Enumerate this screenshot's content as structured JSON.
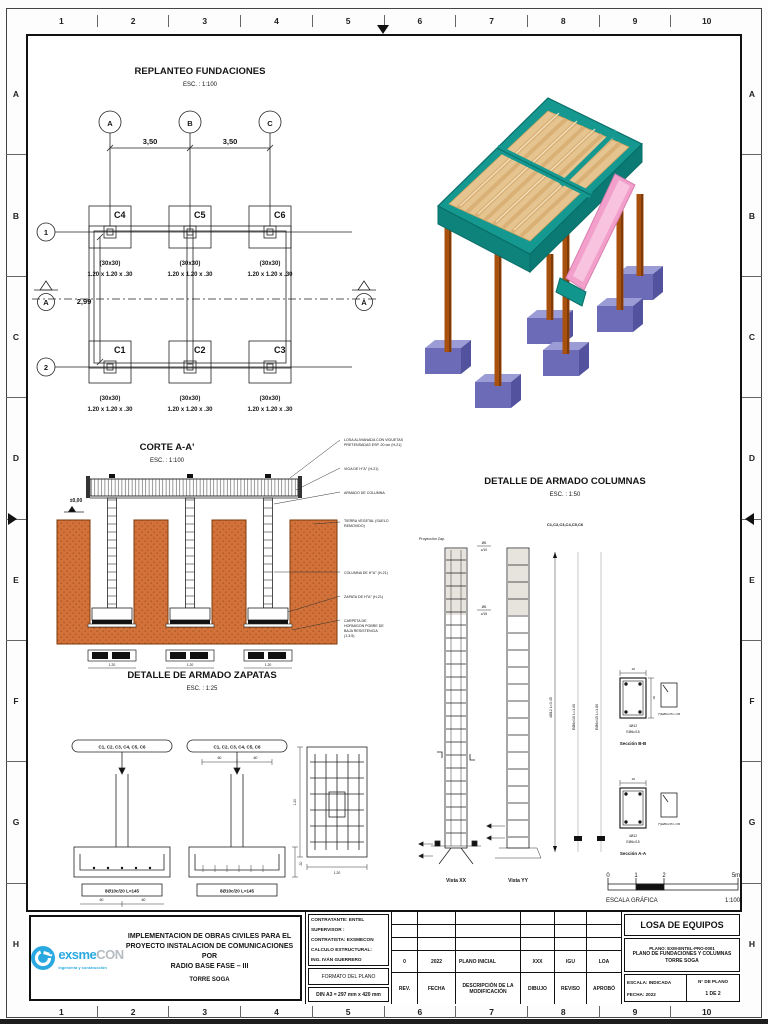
{
  "sheet": {
    "cols": [
      "1",
      "2",
      "3",
      "4",
      "5",
      "6",
      "7",
      "8",
      "9",
      "10"
    ],
    "rows": [
      "A",
      "B",
      "C",
      "D",
      "E",
      "F",
      "G",
      "H"
    ]
  },
  "replanteo": {
    "title": "REPLANTEO FUNDACIONES",
    "scale": "ESC. : 1:100",
    "axis_a": "A",
    "axis_b": "B",
    "axis_c": "C",
    "row_1": "1",
    "row_2": "2",
    "dim_ab": "3,50",
    "dim_bc": "3,50",
    "dim_12": "2,99",
    "section_left": "A",
    "section_right": "A",
    "columns": [
      {
        "name": "C4",
        "size": "(30x30)",
        "footing": "1.20 x 1.20 x .30"
      },
      {
        "name": "C5",
        "size": "(30x30)",
        "footing": "1.20 x 1.20 x .30"
      },
      {
        "name": "C6",
        "size": "(30x30)",
        "footing": "1.20 x 1.20 x .30"
      },
      {
        "name": "C1",
        "size": "(30x30)",
        "footing": "1.20 x 1.20 x .30"
      },
      {
        "name": "C2",
        "size": "(30x30)",
        "footing": "1.20 x 1.20 x .30"
      },
      {
        "name": "C3",
        "size": "(30x30)",
        "footing": "1.20 x 1.20 x .30"
      }
    ]
  },
  "corte": {
    "title": "CORTE A-A'",
    "scale": "ESC. : 1:100",
    "level": "±0,00",
    "callout_1a": "LOSA ALIVIANADA CON VIGUETAS",
    "callout_1b": "PRETENSADAS ESP. 20 cm (H-21)",
    "callout_2": "VIGA DE H°A° (H-21)",
    "callout_3": "ARMADO DE COLUMNA",
    "callout_4a": "TIERRA VEGETAL (SUELO",
    "callout_4b": "REMOVIDO)",
    "callout_5": "COLUMNA DE H°A° (H-21)",
    "callout_6": "ZAPATA DE H°A° (H-21)",
    "callout_7a": "CARPETA DE",
    "callout_7b": "HORMIGON POBRE DE",
    "callout_7c": "BAJA RESISTENCIA",
    "callout_7d": "(1:3:5)",
    "dim_footing": "1.20"
  },
  "zapatas": {
    "title": "DETALLE DE ARMADO ZAPATAS",
    "scale": "ESC. : 1:25",
    "tag_1": "C1, C2, C3, C4, C5, C6",
    "tag_2": "C1, C2, C3, C4, C5, C6",
    "bar_label_1": "8Ø10c/20 L=145",
    "bar_label_2": "8Ø10c/20 L=145",
    "dim_a": ".60",
    "dim_b": ".60",
    "dim_top_a": ".60",
    "dim_top_b": ".60",
    "dim_side": ".30",
    "plan_dim_w": "1.20",
    "plan_dim_h": "1.20"
  },
  "columnas": {
    "title": "DETALLE DE ARMADO COLUMNAS",
    "scale": "ESC. : 1:50",
    "tag": "C1,C2,C3,C4,C5,C6",
    "proyeccion": "Proyección Zap.",
    "frac1_a": "Ø6",
    "frac1_b": "c/10",
    "frac2_a": "Ø6",
    "frac2_b": "c/15",
    "vista_1": "Vista XX",
    "vista_2": "Vista YY",
    "dim_total": "4Ø12 L=3.45",
    "rot_label_1": "EØ6c/10 L=1.00",
    "rot_label_2": "EØ6c/15 L=1.80",
    "dim_w": ".20",
    "dim_h": ".30",
    "sec_b_bars": "4Ø12",
    "sec_b_stirrup": "EØ6c/15",
    "sec_b_title": "Sección B-B",
    "sec_a_bars": "4Ø12",
    "sec_a_stirrup": "EØ6c/15",
    "sec_a_title": "Sección A-A",
    "stirrup_note_1": "(*)EØ6c/15 L=45",
    "stirrup_note_2": "(*)EØ6c/15 L=45"
  },
  "graphic_scale": {
    "t0": "0",
    "t1": "1",
    "t2": "2",
    "t5": "5m",
    "label": "ESCALA GRÁFICA",
    "ratio": "1:100"
  },
  "titleblock": {
    "logo_main": "exsme",
    "logo_suffix": "CON",
    "logo_tagline": "ingeniería y construcción",
    "project_line1": "IMPLEMENTACION DE OBRAS CIVILES PARA EL",
    "project_line2": "PROYECTO INSTALACION DE COMUNICACIONES POR",
    "project_line3": "RADIO BASE FASE – III",
    "project_line4": "TORRE SOGA",
    "info_line1": "CONTRATANTE: ENTEL",
    "info_line2": "SUPERVISOR :",
    "info_line3": "CONTRATISTA: EXSMECON",
    "info_line4": "CALCULO ESTRUCTURAL:",
    "info_line5": "ING. IVÁN GUERRERO",
    "formato_label": "FORMATO DEL PLANO",
    "formato_value": "DIN A3 = 297 mm x 420 mm",
    "rev_value": "0",
    "fecha_value": "2022",
    "desc_value": "PLANO INICIAL",
    "dibujo_value": "XXX",
    "reviso_value": "IGU",
    "aprobo_value": "LOA",
    "rev_label": "REV.",
    "fecha_label": "FECHA",
    "desc_label": "DESCRIPCIÓN DE LA MODIFICACIÓN",
    "dibujo_label": "DIBUJO",
    "reviso_label": "REVISO",
    "aprobo_label": "APROBÓ",
    "sheet_title": "LOSA DE EQUIPOS",
    "plano_code": "PLANO: EXM-ENTEL-PRO-0001",
    "plano_desc": "PLANO DE FUNDACIONES Y COLUMNAS",
    "plano_site": "TORRE SOGA",
    "escala_text": "ESCALA: INDICADA",
    "fecha_text": "FECHA:   2022",
    "nplano_label": "N° DE PLANO",
    "nplano_value": "1 DE 2"
  },
  "colors": {
    "ground_orange": "#D2713A",
    "deck_teal": "#159890",
    "joist_tan": "#E6C490",
    "ramp_pink": "#F2A0CB",
    "column_brown": "#A8500E",
    "footing_purple": "#7575C1",
    "logo_blue": "#2AA9E0"
  }
}
